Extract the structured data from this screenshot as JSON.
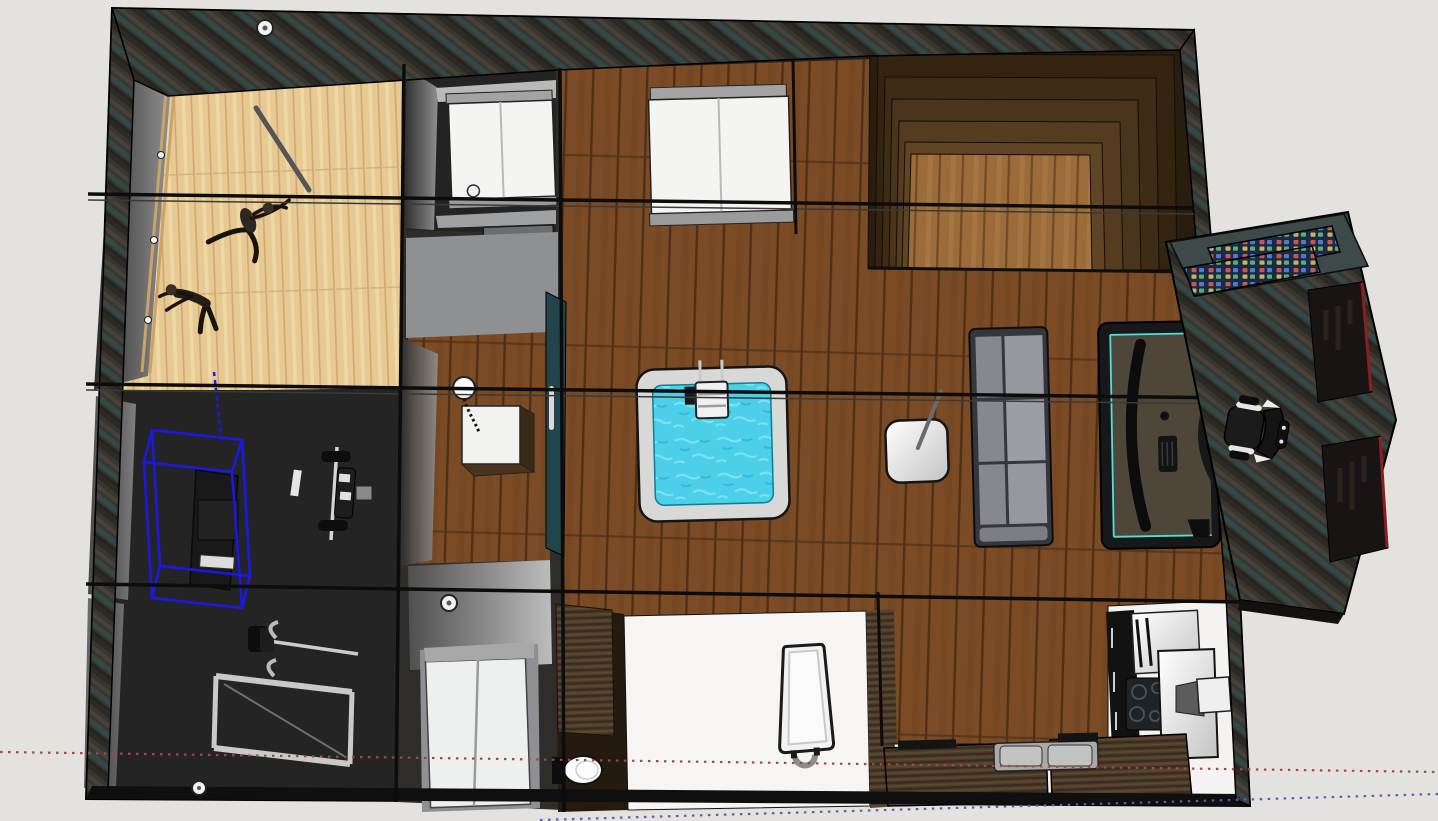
{
  "viewport": {
    "app": "3d-modeling-viewport",
    "view": "top-down orbit view of a furnished loft floor plan",
    "background": "#e3e2df",
    "selection_color": "#1b18e6",
    "axis_red": "#a84545",
    "axis_blue": "#5c5cb0"
  },
  "colors": {
    "exterior_wall": "#36332c",
    "wall_teal_streak": "#2f4f4e",
    "living_floor": "#7b4b26",
    "living_floor_line": "#4f3015",
    "dance_floor": "#e7c994",
    "dance_floor_line": "#cfa96e",
    "gym_floor": "#242424",
    "sauna_bench_dark": "#2a1c0f",
    "sauna_bench_light": "#5f4526",
    "sauna_floor": "#9b6b3a",
    "bathroom_floor": "#f6f5f3",
    "kitchen_floor": "#f4f3f1",
    "hot_tub_water": "#4ccfe9",
    "hot_tub_rim": "#d8d8d6",
    "sofa_gray": "#95999f",
    "desk_accent": "#4fe0d6",
    "bed_white": "#f4f4f3",
    "counter_wood": "#4e3d2b",
    "screen_navy": "#1b2a44",
    "panel_red_trim": "#8a1f1f"
  },
  "scene": {
    "selected_object": "gym-cable-machine",
    "rooms": [
      "dance-studio",
      "gym",
      "bedroom-1",
      "bedroom-2",
      "shower-room",
      "mudroom",
      "closet",
      "bathroom",
      "kitchen",
      "living-area",
      "sauna",
      "gaming-nook-annex"
    ],
    "furniture": [
      "ballet-barre",
      "dancer-figures",
      "cable-machine",
      "bench-press",
      "power-rack",
      "bed",
      "bed",
      "dresser",
      "shower-tray",
      "shower-head",
      "toilet",
      "bathtub",
      "closet-doors",
      "hot-tub",
      "hot-tub-ladder",
      "side-table-lamp",
      "sofa",
      "gaming-desk",
      "gaming-chair",
      "sauna-tier-benches",
      "screen-wall",
      "kitchen-tall-cabinets",
      "cooktop",
      "kitchen-island",
      "sink",
      "counters"
    ]
  }
}
